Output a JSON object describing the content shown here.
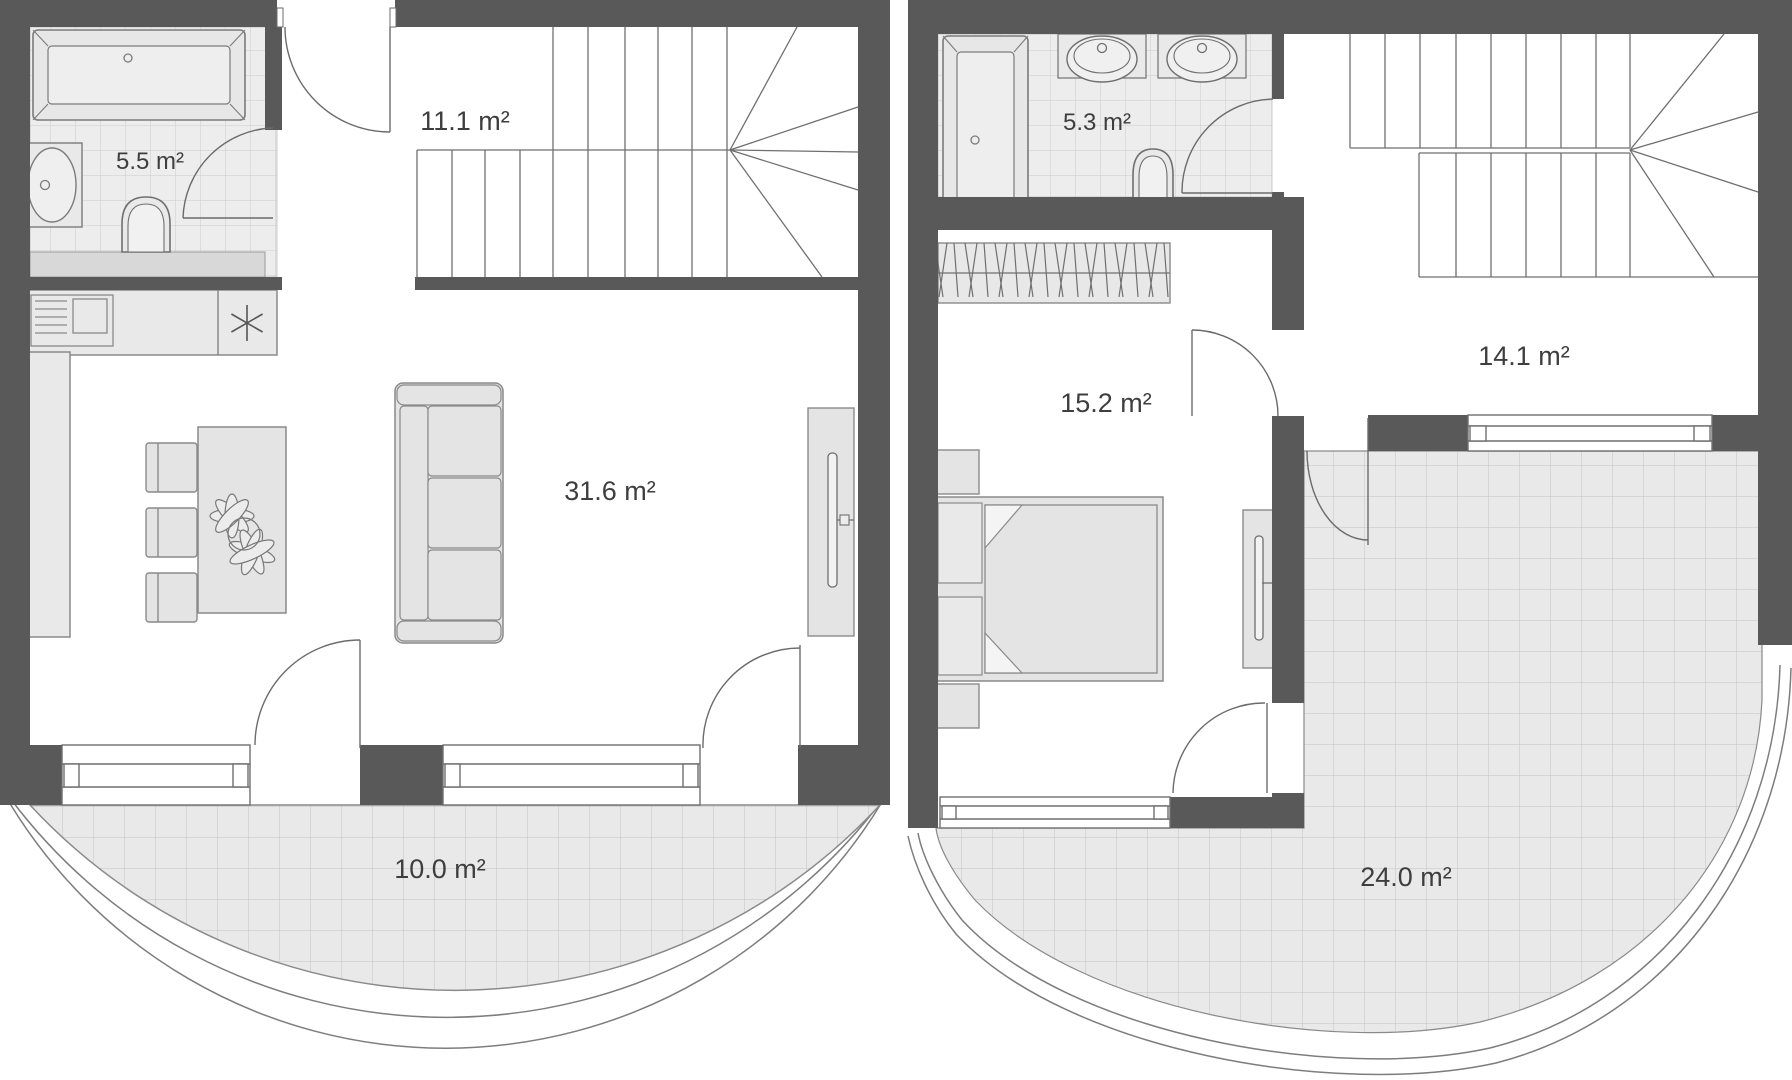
{
  "document": {
    "type": "floor-plan",
    "units": "m²"
  },
  "colors": {
    "wall": "#595959",
    "floor": "#ffffff",
    "tile_fill": "#ededed",
    "tile_line": "#cccccc",
    "balcony_fill": "#e9e9e9",
    "balcony_line": "#c3c3c3",
    "furniture_fill": "#e4e4e4",
    "furniture_stroke": "#8a8a8a",
    "label_text": "#3e3e3e"
  },
  "plans": [
    {
      "name": "lower-floor",
      "rooms": [
        {
          "key": "bathroom",
          "area_label": "5.5 m²"
        },
        {
          "key": "stair-hall",
          "area_label": "11.1 m²"
        },
        {
          "key": "living-room",
          "area_label": "31.6 m²"
        },
        {
          "key": "balcony",
          "area_label": "10.0 m²"
        }
      ]
    },
    {
      "name": "upper-floor",
      "rooms": [
        {
          "key": "bathroom",
          "area_label": "5.3 m²"
        },
        {
          "key": "stair-hall",
          "area_label": "14.1 m²"
        },
        {
          "key": "bedroom",
          "area_label": "15.2 m²"
        },
        {
          "key": "terrace",
          "area_label": "24.0 m²"
        }
      ]
    }
  ]
}
